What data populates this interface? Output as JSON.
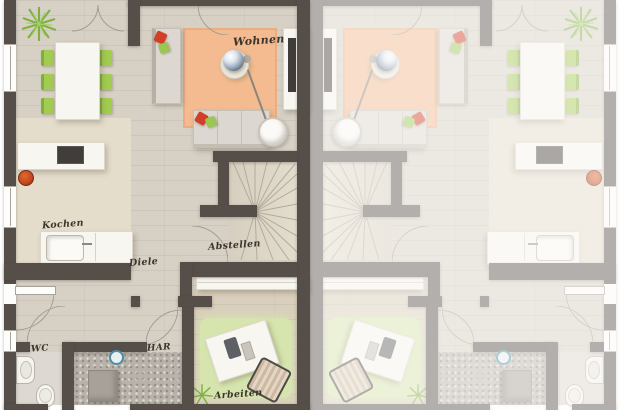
{
  "rooms": {
    "living": "Wohnen",
    "kitchen": "Kochen",
    "hallway": "Diele",
    "storage": "Abstellen",
    "wc": "WC",
    "utility": "HAR",
    "office": "Arbeiten"
  },
  "colors": {
    "wall": "#564f49",
    "floor": "#d6d0c5",
    "floor-kitchen": "#e5ddcb",
    "floor-office": "#d9cfbc",
    "floor-utility": "#b8b2aa",
    "floor-wc": "#ddd8d1",
    "rug-living": "#f3bb8f",
    "rug-office": "#d6e5ae",
    "green-chair": "#a2cb51",
    "pillow-red": "#d23f28",
    "pillow-green": "#9cc653",
    "white-furniture": "#f8f6f1",
    "stairs": "#ded7c8",
    "ink": "#3b352c"
  }
}
